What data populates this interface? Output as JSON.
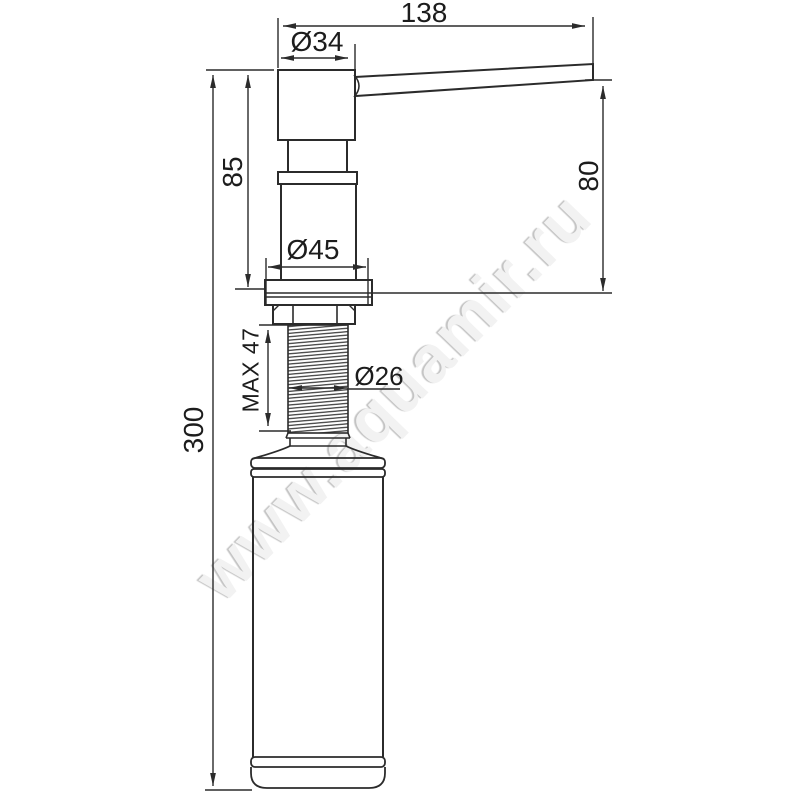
{
  "drawing": {
    "type": "technical-dimension-drawing",
    "subject": "kitchen soap dispenser side view",
    "watermark": "www.aquamir.ru",
    "dimensions": {
      "spout_length": "138",
      "spout_diameter": "Ø34",
      "head_height": "85",
      "spout_height_above_counter": "80",
      "body_diameter": "Ø45",
      "thread_length_max": "MAX 47",
      "thread_diameter": "Ø26",
      "total_height": "300"
    },
    "colors": {
      "line": "#2b2b2b",
      "text": "#1c1c1c",
      "watermark": "#f2f2f2"
    }
  }
}
